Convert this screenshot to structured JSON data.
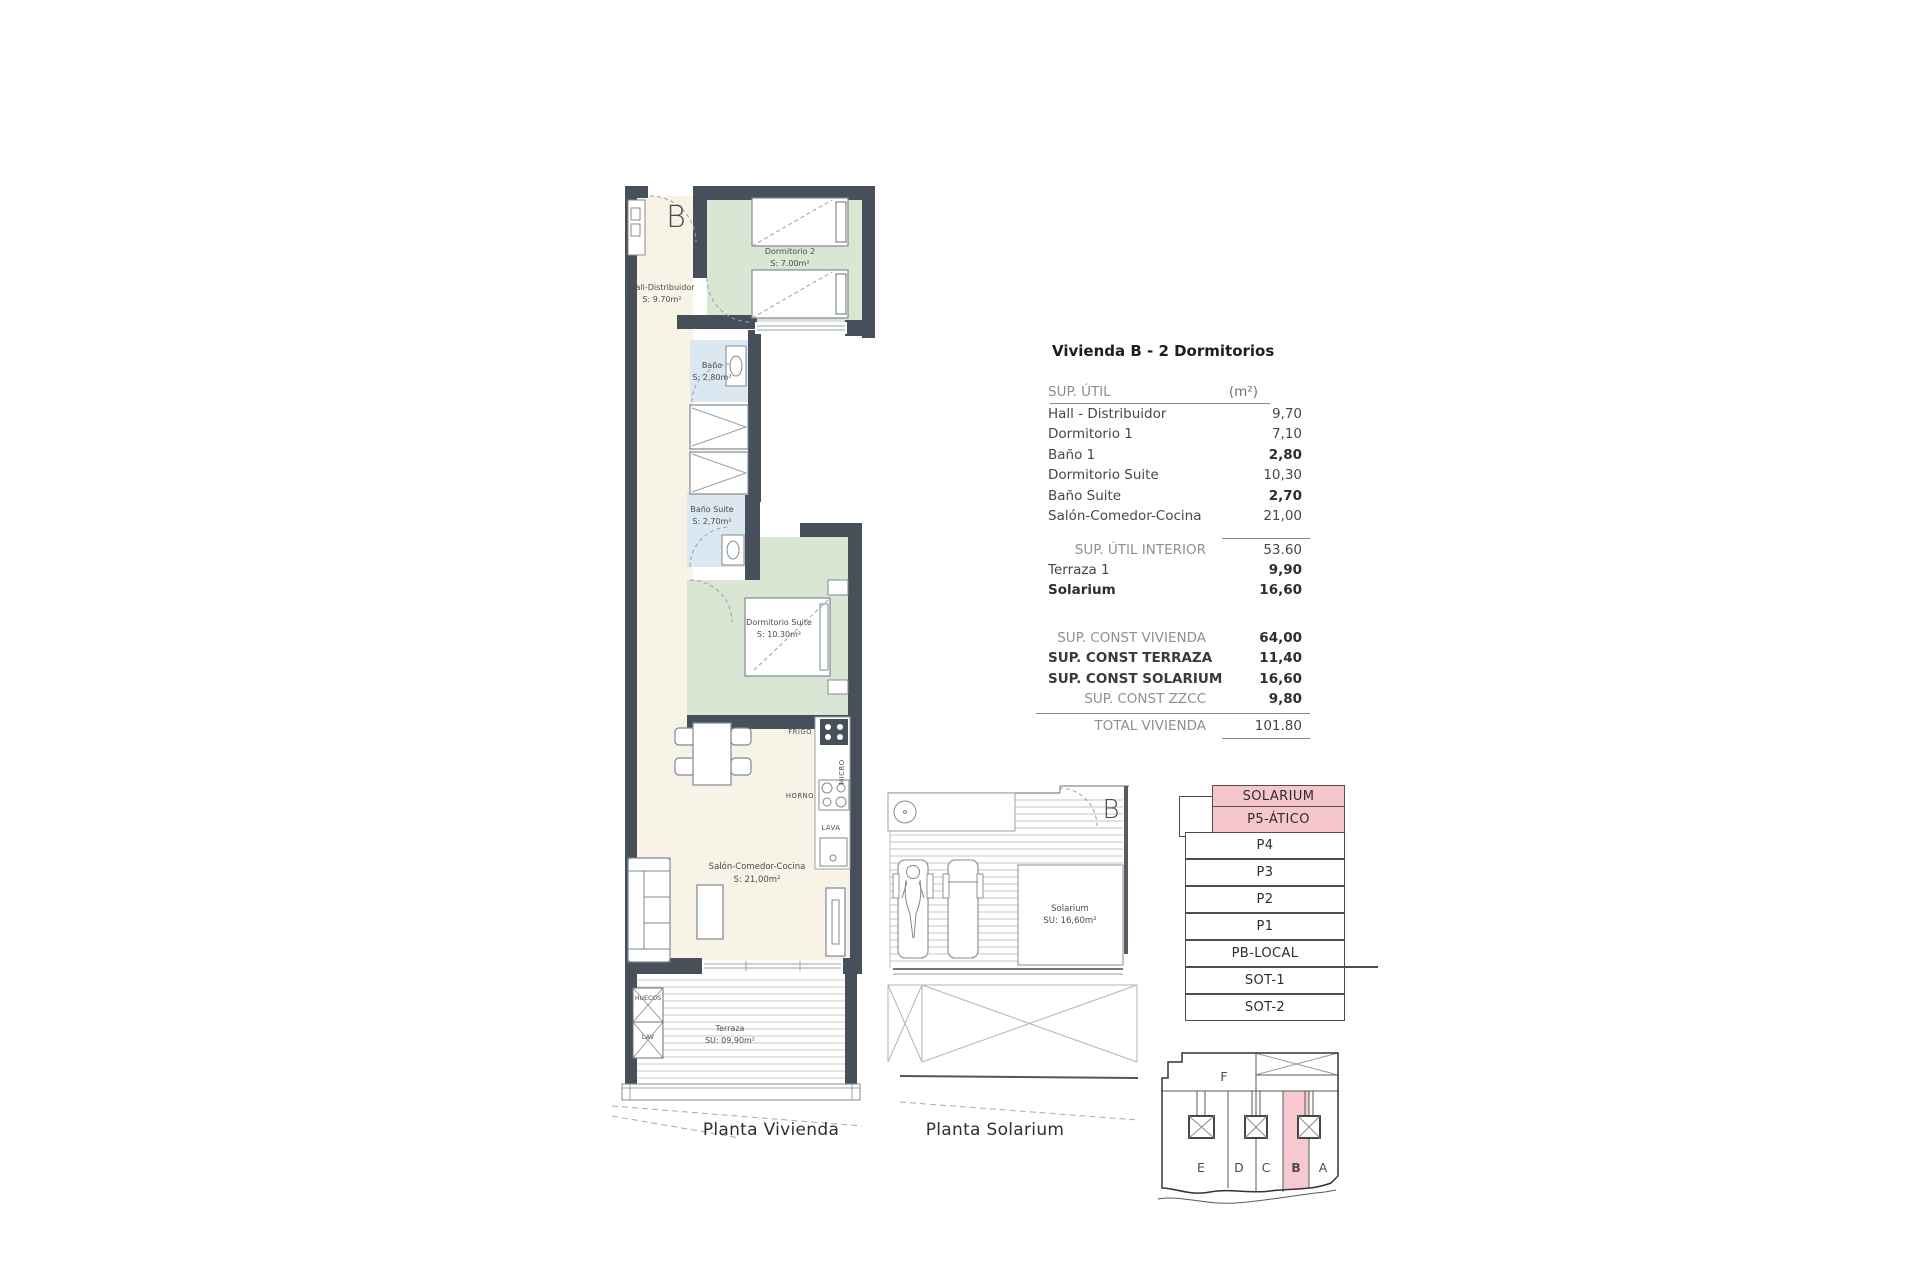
{
  "colors": {
    "wall": "#47505a",
    "floor_cream": "#f8f3e7",
    "floor_green": "#d8e6d3",
    "floor_blue": "#dbe7f1",
    "highlight_pink": "#f5c6cb",
    "highlight_red": "#9c3438"
  },
  "floor_plan": {
    "caption": "Planta Vivienda",
    "entrance_label": "B",
    "rooms": {
      "hall": {
        "name": "Hall-Distribuidor",
        "area": "S: 9.70m²"
      },
      "dormitorio2": {
        "name": "Dormitorio 2",
        "area": "S: 7.00m²"
      },
      "bano": {
        "name": "Baño",
        "area": "S: 2,80m²"
      },
      "bano_suite": {
        "name": "Baño Suite",
        "area": "S: 2,70m²"
      },
      "dormitorio_suite": {
        "name": "Dormitorio Suite",
        "area": "S: 10.30m²"
      },
      "salon": {
        "name": "Salón-Comedor-Cocina",
        "area": "S: 21,00m²"
      },
      "terraza": {
        "name": "Terraza",
        "area": "SU: 09,90m²"
      }
    },
    "labels": {
      "frigo": "FRIGO",
      "micro": "MICRO",
      "horno": "HORNO",
      "lava": "LAVA",
      "huecos": "HUECOS",
      "lav": "LAV"
    }
  },
  "solarium_plan": {
    "caption": "Planta Solarium",
    "entrance_label": "B",
    "room": {
      "name": "Solarium",
      "area": "SU: 16,60m²"
    }
  },
  "area_table": {
    "title": "Vivienda B - 2 Dormitorios",
    "header": {
      "label": "SUP. ÚTIL",
      "unit": "(m²)"
    },
    "rows": [
      {
        "label": "Hall - Distribuidor",
        "value": "9,70"
      },
      {
        "label": "Dormitorio 1",
        "value": "7,10"
      },
      {
        "label": "Baño 1",
        "value": "2,80"
      },
      {
        "label": "Dormitorio Suite",
        "value": "10,30"
      },
      {
        "label": "Baño Suite",
        "value": "2,70"
      },
      {
        "label": "Salón-Comedor-Cocina",
        "value": "21,00"
      },
      {
        "label": "SUP. ÚTIL INTERIOR",
        "value": "53.60"
      },
      {
        "label": "Terraza 1",
        "value": "9,90"
      },
      {
        "label": "Solarium",
        "value": "16,60"
      },
      {
        "label": "SUP. CONST VIVIENDA",
        "value": "64,00"
      },
      {
        "label": "SUP. CONST TERRAZA",
        "value": "11,40"
      },
      {
        "label": "SUP. CONST SOLARIUM",
        "value": "16,60"
      },
      {
        "label": "SUP. CONST ZZCC",
        "value": "9,80"
      },
      {
        "label": "TOTAL VIVIENDA",
        "value": "101.80"
      }
    ]
  },
  "stack_diagram": {
    "levels": [
      "SOLARIUM",
      "P5-ÁTICO",
      "P4",
      "P3",
      "P2",
      "P1",
      "PB-LOCAL",
      "SOT-1",
      "SOT-2"
    ],
    "highlighted_levels": [
      "SOLARIUM",
      "P5-ÁTICO"
    ]
  },
  "footprint": {
    "top_unit": "F",
    "units": [
      "E",
      "D",
      "C",
      "B",
      "A"
    ],
    "highlighted_unit": "B"
  }
}
